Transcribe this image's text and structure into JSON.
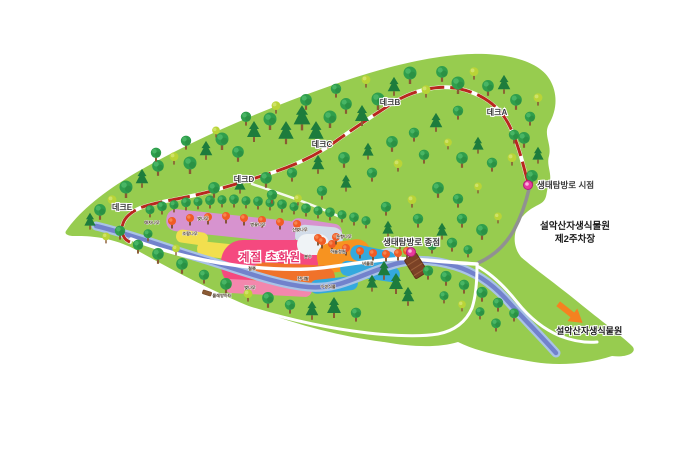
{
  "map": {
    "colors": {
      "background": "#ffffff",
      "terrain": "#97cc4f",
      "river_core": "#7282cc",
      "river_edge": "#a9c3e6",
      "trail_red": "#b8281e",
      "path_white": "#ffffff",
      "road_gray": "#919191",
      "marker_pink": "#e83a9c",
      "arrow_orange": "#f58220",
      "bridge_brown": "#7b4226"
    },
    "deck_labels": [
      {
        "id": "deck-a",
        "text": "데크A",
        "x": 497,
        "y": 115
      },
      {
        "id": "deck-b",
        "text": "데크B",
        "x": 390,
        "y": 105
      },
      {
        "id": "deck-c",
        "text": "데크C",
        "x": 322,
        "y": 147
      },
      {
        "id": "deck-d",
        "text": "데크D",
        "x": 244,
        "y": 182
      },
      {
        "id": "deck-e",
        "text": "데크E",
        "x": 122,
        "y": 210
      }
    ],
    "markers": [
      {
        "id": "trail-start",
        "text": "생태탐방로 시점",
        "tx": 537,
        "ty": 188,
        "dx": 528,
        "dy": 185,
        "anchor": "start"
      },
      {
        "id": "trail-end",
        "text": "생태탐방로 종점",
        "tx": 383,
        "ty": 245,
        "dx": 411,
        "dy": 252,
        "anchor": "start"
      }
    ],
    "parking_label": {
      "lines": [
        "설악산자생식물원",
        "제2주차장"
      ],
      "x": 575,
      "y": 229,
      "line_height": 13
    },
    "exit_label": {
      "text": "설악산자생식물원",
      "x": 556,
      "y": 334
    },
    "garden_title": {
      "text": "계절 초화원",
      "x": 270,
      "y": 261
    },
    "garden_zones": [
      {
        "x": 166,
        "y": 215,
        "w": 132,
        "h": 22,
        "rot": 6,
        "color": "#d793cf",
        "rx": 10
      },
      {
        "x": 290,
        "y": 221,
        "w": 52,
        "h": 17,
        "rot": 9,
        "color": "#d793cf",
        "rx": 8
      },
      {
        "x": 176,
        "y": 231,
        "w": 32,
        "h": 13,
        "rot": 8,
        "color": "#f2df4e",
        "rx": 6
      },
      {
        "x": 197,
        "y": 243,
        "w": 44,
        "h": 15,
        "rot": 6,
        "color": "#f2df4e",
        "rx": 7
      },
      {
        "x": 295,
        "y": 226,
        "w": 48,
        "h": 21,
        "rot": 5,
        "color": "#d2dce9",
        "rx": 10
      },
      {
        "x": 221,
        "y": 240,
        "w": 97,
        "h": 48,
        "rot": 0,
        "color": "#f5497f",
        "rx": 22
      },
      {
        "x": 297,
        "y": 234,
        "w": 32,
        "h": 21,
        "rot": 0,
        "color": "#eff3f6",
        "rx": 10
      },
      {
        "x": 358,
        "y": 250,
        "w": 44,
        "h": 22,
        "rot": -14,
        "color": "#ccd7e6",
        "rx": 11
      },
      {
        "x": 317,
        "y": 241,
        "w": 54,
        "h": 30,
        "rot": -8,
        "color": "#f79320",
        "rx": 14
      },
      {
        "x": 251,
        "y": 264,
        "w": 84,
        "h": 26,
        "rot": 3,
        "color": "#f0722a",
        "rx": 12
      },
      {
        "x": 350,
        "y": 248,
        "w": 46,
        "h": 16,
        "rot": 12,
        "color": "#34a9de",
        "rx": 8
      },
      {
        "x": 340,
        "y": 264,
        "w": 60,
        "h": 15,
        "rot": 8,
        "color": "#34a9de",
        "rx": 7
      },
      {
        "x": 224,
        "y": 281,
        "w": 88,
        "h": 14,
        "rot": 3,
        "color": "#f387ad",
        "rx": 7
      },
      {
        "x": 310,
        "y": 278,
        "w": 48,
        "h": 14,
        "rot": -6,
        "color": "#34a9de",
        "rx": 7
      }
    ],
    "garden_zone_labels": [
      {
        "text": "매자나무",
        "x": 152,
        "y": 224
      },
      {
        "text": "벚나무",
        "x": 203,
        "y": 220
      },
      {
        "text": "조팝나무",
        "x": 190,
        "y": 235
      },
      {
        "text": "병꽃나무",
        "x": 258,
        "y": 226
      },
      {
        "text": "산벚나무",
        "x": 300,
        "y": 231
      },
      {
        "text": "눈향나무",
        "x": 344,
        "y": 238
      },
      {
        "text": "철쭉",
        "x": 252,
        "y": 270
      },
      {
        "text": "분수",
        "x": 308,
        "y": 258
      },
      {
        "text": "하늘정원",
        "x": 338,
        "y": 253
      },
      {
        "text": "잔디밭",
        "x": 303,
        "y": 280
      },
      {
        "text": "버들류",
        "x": 368,
        "y": 265
      },
      {
        "text": "벚나무",
        "x": 250,
        "y": 289
      },
      {
        "text": "수생식물",
        "x": 328,
        "y": 288
      },
      {
        "text": "물레방아터",
        "x": 222,
        "y": 297
      }
    ],
    "trees": [
      [
        150,
        216,
        "r",
        0.7
      ],
      [
        162,
        213,
        "r",
        0.75
      ],
      [
        174,
        211,
        "r",
        0.7
      ],
      [
        186,
        209,
        "r",
        0.75
      ],
      [
        198,
        208,
        "r",
        0.7
      ],
      [
        210,
        207,
        "r",
        0.75
      ],
      [
        222,
        206,
        "r",
        0.7
      ],
      [
        234,
        206,
        "r",
        0.75
      ],
      [
        246,
        207,
        "r",
        0.7
      ],
      [
        258,
        208,
        "r",
        0.75
      ],
      [
        270,
        209,
        "r",
        0.7
      ],
      [
        282,
        211,
        "r",
        0.75
      ],
      [
        294,
        213,
        "r",
        0.7
      ],
      [
        306,
        215,
        "r",
        0.75
      ],
      [
        318,
        217,
        "r",
        0.7
      ],
      [
        330,
        219,
        "r",
        0.75
      ],
      [
        342,
        221,
        "r",
        0.7
      ],
      [
        354,
        224,
        "r",
        0.75
      ],
      [
        366,
        227,
        "r",
        0.7
      ],
      [
        172,
        227,
        "a",
        1
      ],
      [
        190,
        224,
        "a",
        1
      ],
      [
        208,
        223,
        "a",
        1
      ],
      [
        226,
        222,
        "a",
        1
      ],
      [
        244,
        224,
        "a",
        1
      ],
      [
        262,
        226,
        "a",
        1
      ],
      [
        280,
        228,
        "a",
        1
      ],
      [
        297,
        230,
        "a",
        1
      ],
      [
        318,
        244,
        "a",
        1
      ],
      [
        332,
        250,
        "a",
        1
      ],
      [
        346,
        254,
        "a",
        1
      ],
      [
        360,
        257,
        "a",
        1
      ],
      [
        373,
        259,
        "a",
        1
      ],
      [
        386,
        260,
        "a",
        1
      ],
      [
        398,
        259,
        "a",
        1
      ],
      [
        407,
        257,
        "a",
        1
      ],
      [
        322,
        247,
        "a",
        1
      ],
      [
        336,
        243,
        "a",
        1
      ],
      [
        100,
        218,
        "r",
        0.9
      ],
      [
        90,
        228,
        "p",
        0.8
      ],
      [
        112,
        206,
        "l",
        0.8
      ],
      [
        126,
        196,
        "r",
        1
      ],
      [
        142,
        186,
        "p",
        0.9
      ],
      [
        158,
        174,
        "r",
        0.9
      ],
      [
        174,
        163,
        "l",
        0.8
      ],
      [
        190,
        172,
        "r",
        1
      ],
      [
        206,
        158,
        "p",
        0.9
      ],
      [
        222,
        148,
        "r",
        1
      ],
      [
        238,
        160,
        "r",
        0.9
      ],
      [
        254,
        140,
        "p",
        1
      ],
      [
        270,
        128,
        "r",
        1
      ],
      [
        286,
        142,
        "p",
        1.1
      ],
      [
        302,
        128,
        "p",
        1.2
      ],
      [
        316,
        142,
        "p",
        1.1
      ],
      [
        330,
        126,
        "r",
        1
      ],
      [
        346,
        112,
        "r",
        0.9
      ],
      [
        362,
        124,
        "p",
        1
      ],
      [
        378,
        108,
        "r",
        1
      ],
      [
        394,
        94,
        "p",
        0.9
      ],
      [
        410,
        82,
        "r",
        1
      ],
      [
        426,
        96,
        "l",
        0.8
      ],
      [
        442,
        80,
        "r",
        0.9
      ],
      [
        458,
        92,
        "r",
        1
      ],
      [
        474,
        78,
        "l",
        0.8
      ],
      [
        488,
        94,
        "r",
        0.9
      ],
      [
        366,
        86,
        "l",
        0.8
      ],
      [
        336,
        96,
        "r",
        0.8
      ],
      [
        306,
        108,
        "r",
        0.9
      ],
      [
        276,
        112,
        "l",
        0.8
      ],
      [
        246,
        124,
        "r",
        0.8
      ],
      [
        216,
        136,
        "l",
        0.7
      ],
      [
        186,
        148,
        "r",
        0.8
      ],
      [
        156,
        160,
        "r",
        0.8
      ],
      [
        504,
        92,
        "p",
        0.9
      ],
      [
        516,
        108,
        "r",
        0.9
      ],
      [
        530,
        124,
        "r",
        0.8
      ],
      [
        538,
        104,
        "l",
        0.8
      ],
      [
        524,
        146,
        "r",
        0.9
      ],
      [
        538,
        162,
        "p",
        0.8
      ],
      [
        512,
        164,
        "l",
        0.8
      ],
      [
        532,
        184,
        "r",
        0.9
      ],
      [
        514,
        142,
        "r",
        0.8
      ],
      [
        214,
        196,
        "r",
        0.9
      ],
      [
        240,
        192,
        "p",
        0.8
      ],
      [
        266,
        186,
        "r",
        0.9
      ],
      [
        292,
        180,
        "r",
        0.8
      ],
      [
        318,
        172,
        "p",
        0.9
      ],
      [
        344,
        166,
        "r",
        0.9
      ],
      [
        368,
        158,
        "p",
        0.8
      ],
      [
        392,
        150,
        "r",
        0.9
      ],
      [
        414,
        140,
        "r",
        0.8
      ],
      [
        436,
        130,
        "p",
        0.9
      ],
      [
        458,
        118,
        "r",
        0.8
      ],
      [
        398,
        170,
        "l",
        0.8
      ],
      [
        372,
        180,
        "r",
        0.8
      ],
      [
        346,
        190,
        "p",
        0.8
      ],
      [
        322,
        198,
        "r",
        0.8
      ],
      [
        298,
        204,
        "l",
        0.7
      ],
      [
        272,
        202,
        "r",
        0.8
      ],
      [
        424,
        162,
        "r",
        0.8
      ],
      [
        448,
        148,
        "l",
        0.7
      ],
      [
        462,
        166,
        "r",
        0.9
      ],
      [
        478,
        152,
        "p",
        0.8
      ],
      [
        492,
        170,
        "r",
        0.8
      ],
      [
        438,
        196,
        "r",
        0.9
      ],
      [
        412,
        206,
        "l",
        0.8
      ],
      [
        386,
        214,
        "r",
        0.8
      ],
      [
        458,
        206,
        "r",
        0.8
      ],
      [
        478,
        192,
        "l",
        0.7
      ],
      [
        418,
        226,
        "r",
        0.8
      ],
      [
        442,
        238,
        "p",
        0.8
      ],
      [
        462,
        226,
        "r",
        0.8
      ],
      [
        482,
        238,
        "r",
        0.9
      ],
      [
        498,
        222,
        "l",
        0.7
      ],
      [
        388,
        236,
        "p",
        0.8
      ],
      [
        400,
        248,
        "r",
        0.7
      ],
      [
        432,
        252,
        "r",
        0.75
      ],
      [
        452,
        250,
        "r",
        0.8
      ],
      [
        468,
        256,
        "r",
        0.7
      ],
      [
        384,
        278,
        "p",
        0.9
      ],
      [
        396,
        292,
        "p",
        1
      ],
      [
        408,
        304,
        "p",
        0.9
      ],
      [
        372,
        290,
        "p",
        0.8
      ],
      [
        428,
        278,
        "r",
        0.8
      ],
      [
        446,
        284,
        "r",
        0.85
      ],
      [
        464,
        292,
        "r",
        0.8
      ],
      [
        482,
        300,
        "r",
        0.85
      ],
      [
        498,
        310,
        "r",
        0.8
      ],
      [
        514,
        320,
        "r",
        0.75
      ],
      [
        462,
        310,
        "l",
        0.7
      ],
      [
        444,
        302,
        "r",
        0.7
      ],
      [
        480,
        318,
        "r",
        0.7
      ],
      [
        496,
        330,
        "r",
        0.75
      ],
      [
        120,
        238,
        "r",
        0.8
      ],
      [
        106,
        242,
        "l",
        0.7
      ],
      [
        138,
        252,
        "r",
        0.8
      ],
      [
        158,
        262,
        "r",
        0.9
      ],
      [
        176,
        254,
        "l",
        0.7
      ],
      [
        182,
        272,
        "r",
        0.9
      ],
      [
        204,
        282,
        "r",
        0.8
      ],
      [
        226,
        292,
        "r",
        0.9
      ],
      [
        248,
        300,
        "l",
        0.8
      ],
      [
        268,
        306,
        "r",
        0.9
      ],
      [
        290,
        312,
        "r",
        0.8
      ],
      [
        312,
        318,
        "p",
        0.9
      ],
      [
        334,
        316,
        "p",
        1
      ],
      [
        356,
        320,
        "r",
        0.8
      ],
      [
        148,
        240,
        "r",
        0.7
      ]
    ]
  }
}
